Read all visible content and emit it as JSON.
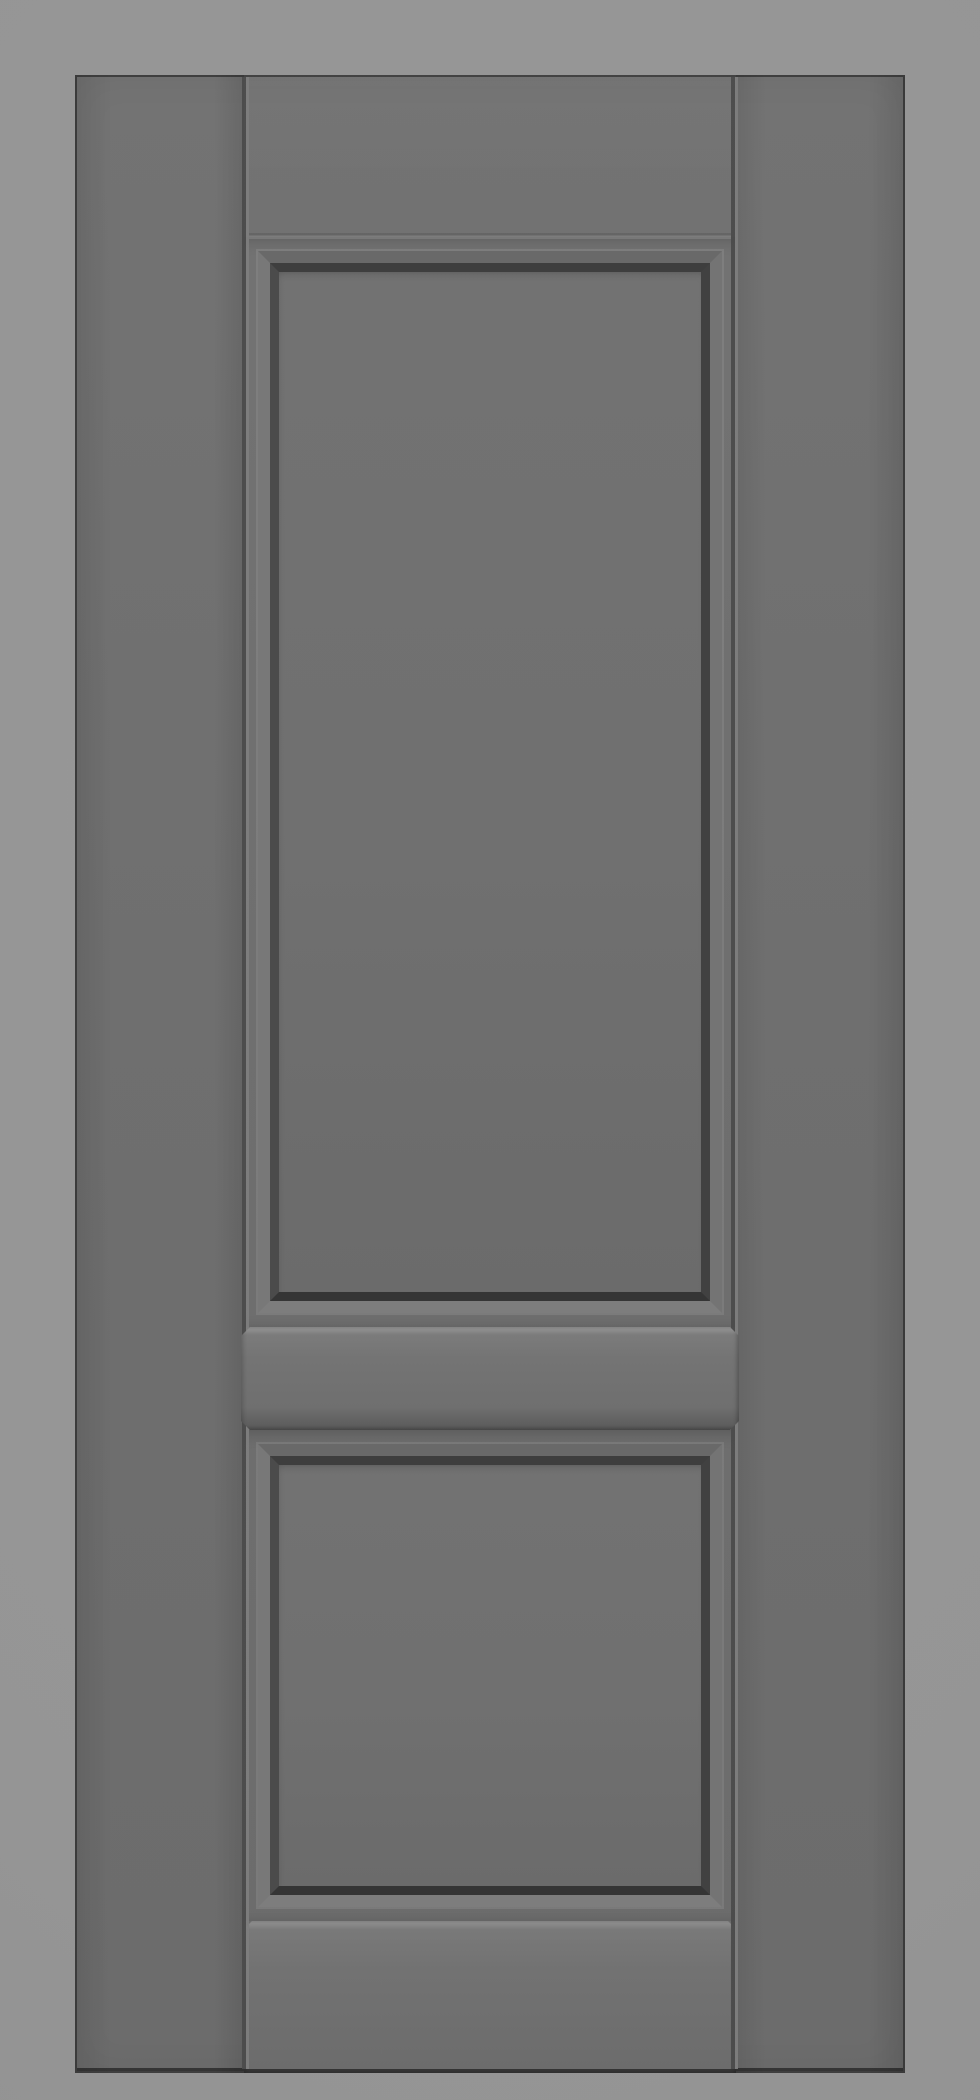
{
  "scene": {
    "description": "Straight-on 3D render of a grey two-panel interior door with shaker-style recessed panels, no hardware, on a plain light grey background",
    "object": "two-panel-door",
    "view": "front",
    "text_content": "none",
    "parts": [
      {
        "name": "left-stile",
        "label": "left stile"
      },
      {
        "name": "right-stile",
        "label": "right stile"
      },
      {
        "name": "top-rail",
        "label": "top rail"
      },
      {
        "name": "upper-panel",
        "label": "upper recessed panel (tall)"
      },
      {
        "name": "lock-rail",
        "label": "raised middle lock rail"
      },
      {
        "name": "lower-panel",
        "label": "lower recessed panel (short)"
      },
      {
        "name": "bottom-rail",
        "label": "raised bottom rail"
      }
    ]
  },
  "colors": {
    "bg": "#959595",
    "door-face-top": "#737373",
    "door-face-bottom": "#6c6c6c",
    "door-edge": "#3f3f3f",
    "door-edge-bottom": "#343434",
    "seam-dark": "#4a4a4a",
    "seam-light": "#7e7e7e",
    "joint-dark": "#616161",
    "joint-light": "#7f7f7f",
    "slope-top": "#696969",
    "slope-right": "#747474",
    "slope-bottom": "#7d7d7d",
    "slope-left": "#787878",
    "groove-top": "#3e3e3e",
    "groove-right": "#414141",
    "groove-bottom": "#353535",
    "groove-left": "#4b4b4b",
    "panel-top": "#727272",
    "panel-mid": "#707070",
    "panel-bottom": "#6b6b6b",
    "rail-hi": "#8d8d8d",
    "rail-hi2": "#7b7b7b",
    "rail-face": "#747474",
    "rail-face2": "#6f6f6f",
    "rail-dark": "#4a4a4a"
  }
}
